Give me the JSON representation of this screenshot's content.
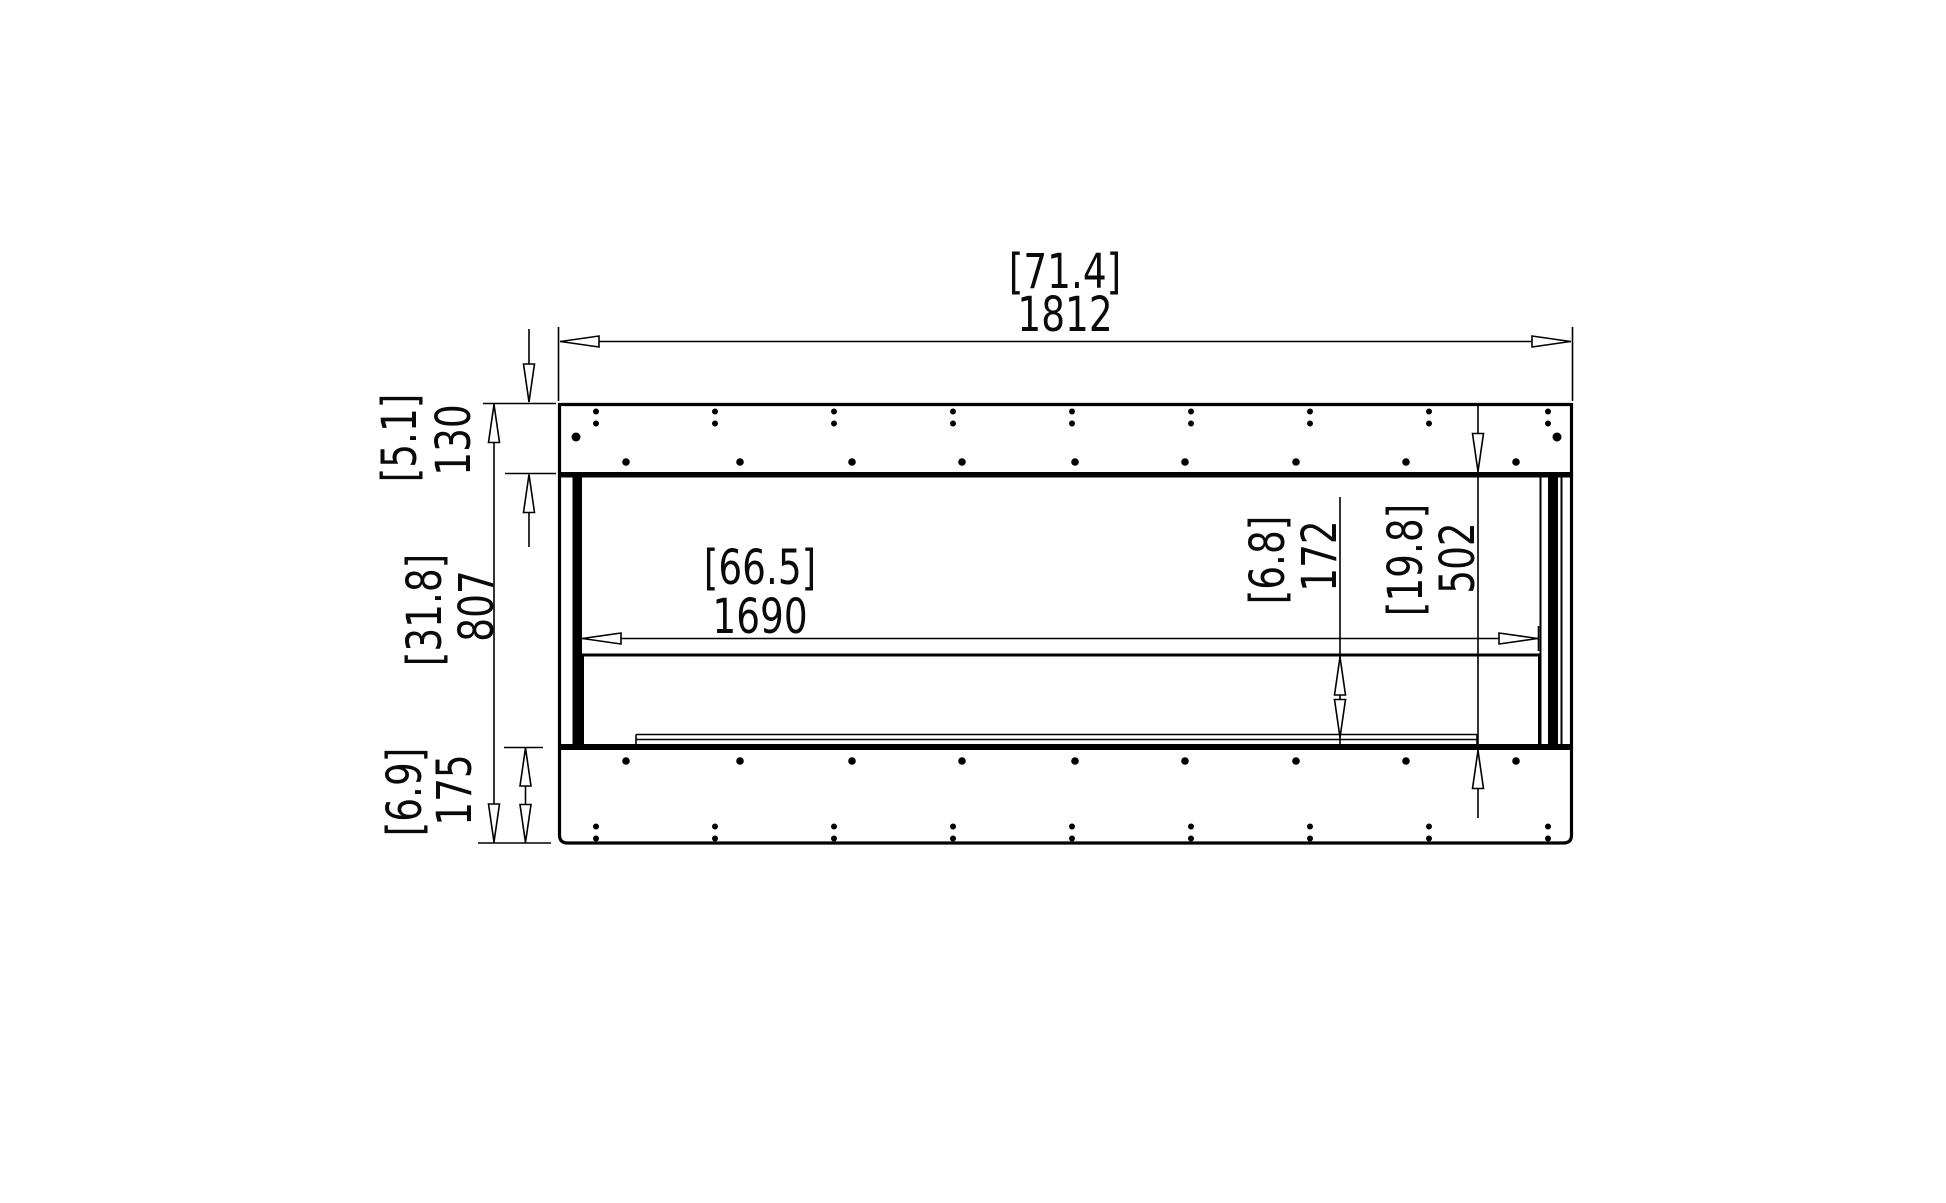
{
  "drawing": {
    "name": "firebox-front-elevation",
    "background": "#ffffff",
    "line_color": "#000000",
    "unit_convention": "bracketed values in inches, plain values in millimetres"
  },
  "dimensions": {
    "overall_width": {
      "imperial": "[71.4]",
      "metric": "1812"
    },
    "top_section_height": {
      "imperial": "[5.1]",
      "metric": "130"
    },
    "overall_height": {
      "imperial": "[31.8]",
      "metric": "807"
    },
    "base_section_height": {
      "imperial": "[6.9]",
      "metric": "175"
    },
    "opening_width": {
      "imperial": "[66.5]",
      "metric": "1690"
    },
    "burner_inset_height": {
      "imperial": "[6.8]",
      "metric": "172"
    },
    "opening_height": {
      "imperial": "[19.8]",
      "metric": "502"
    }
  }
}
